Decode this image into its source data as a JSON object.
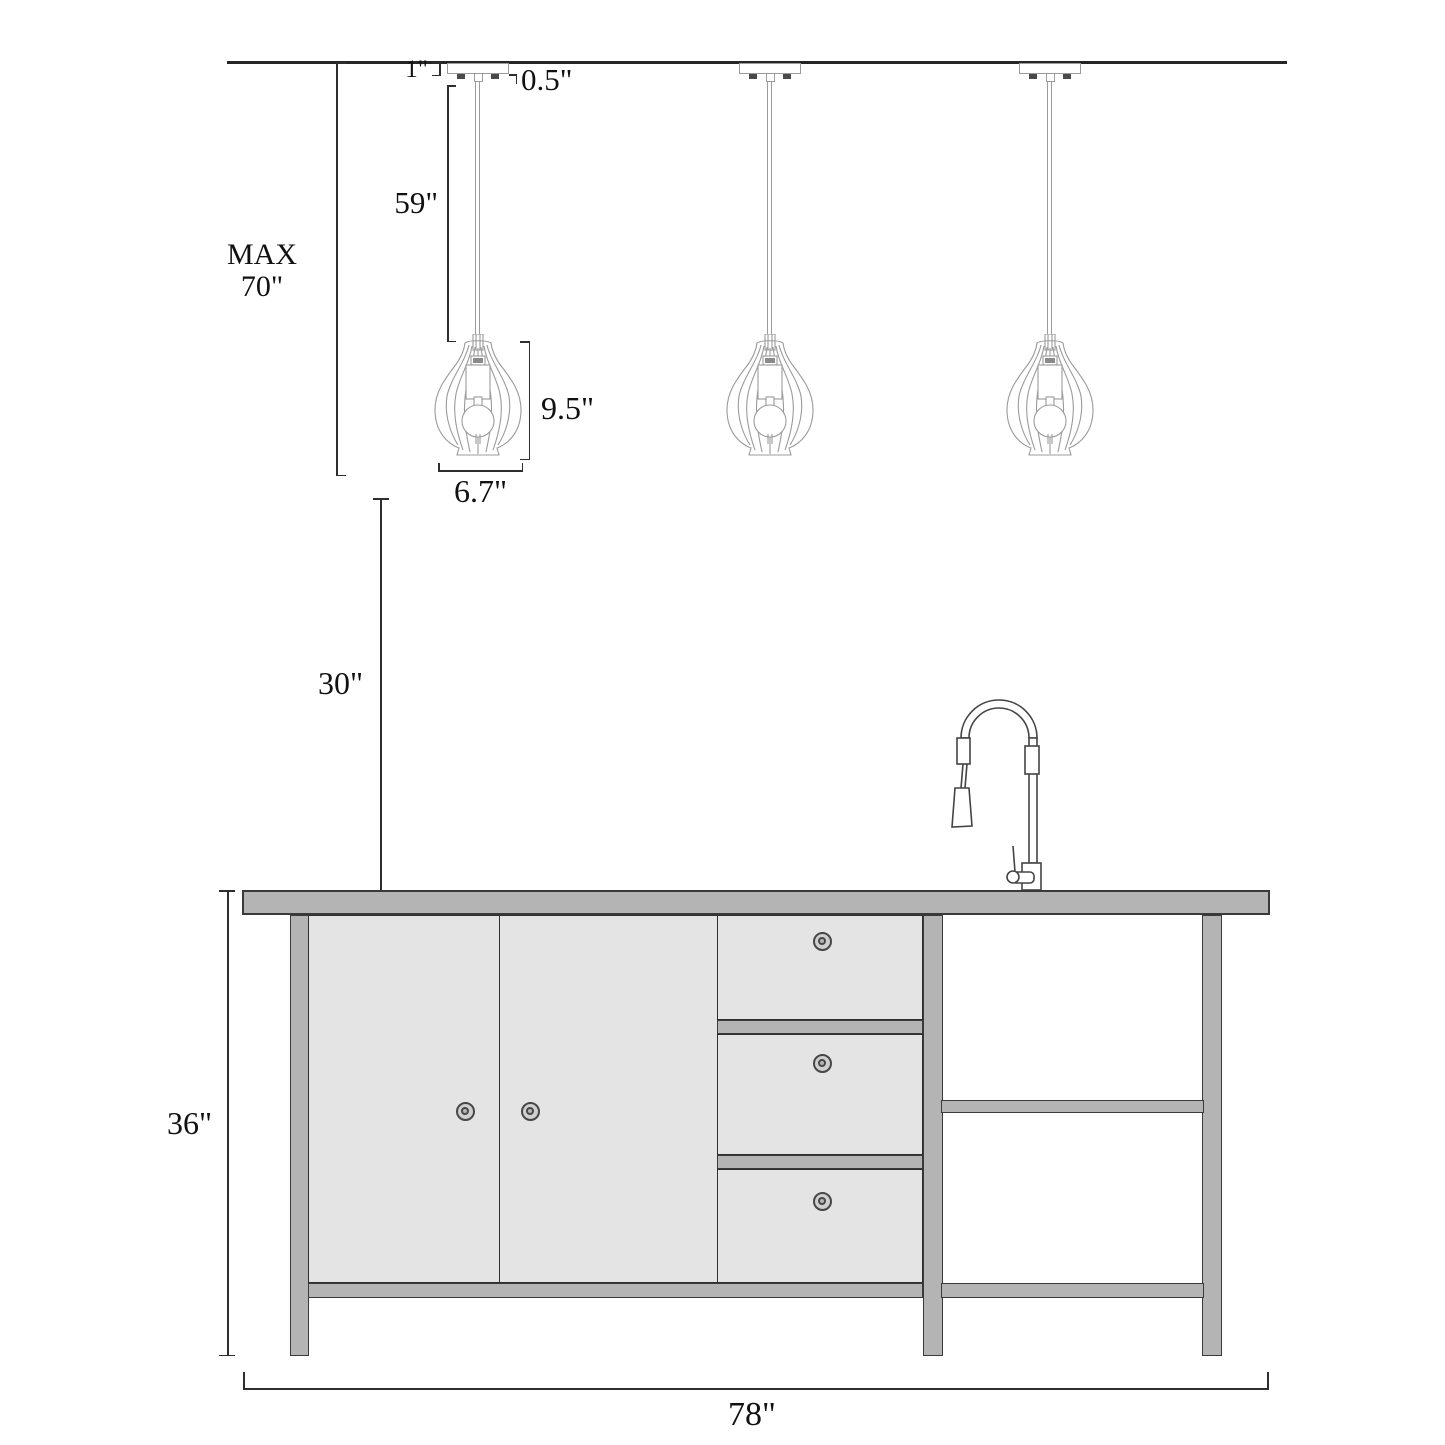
{
  "diagram": {
    "title": "pendant-lights-over-kitchen-island-dimension-diagram",
    "pendant_count": 3
  },
  "dims": {
    "canopy_height": "1\"",
    "hang_straight": "0.5\"",
    "cord_length": "59\"",
    "max_line1": "MAX",
    "max_line2": "70\"",
    "shade_height": "9.5\"",
    "shade_width": "6.7\"",
    "counter_clearance": "30\"",
    "island_height": "36\"",
    "island_width": "78\""
  },
  "colors": {
    "stroke_dark": "#3a3a3a",
    "gray_mid": "#b4b4b4",
    "gray_light": "#e4e4e4",
    "dimension_line": "#2e2e2e",
    "pendant_line": "#9b9b9b",
    "text": "#111111",
    "background": "#ffffff"
  }
}
